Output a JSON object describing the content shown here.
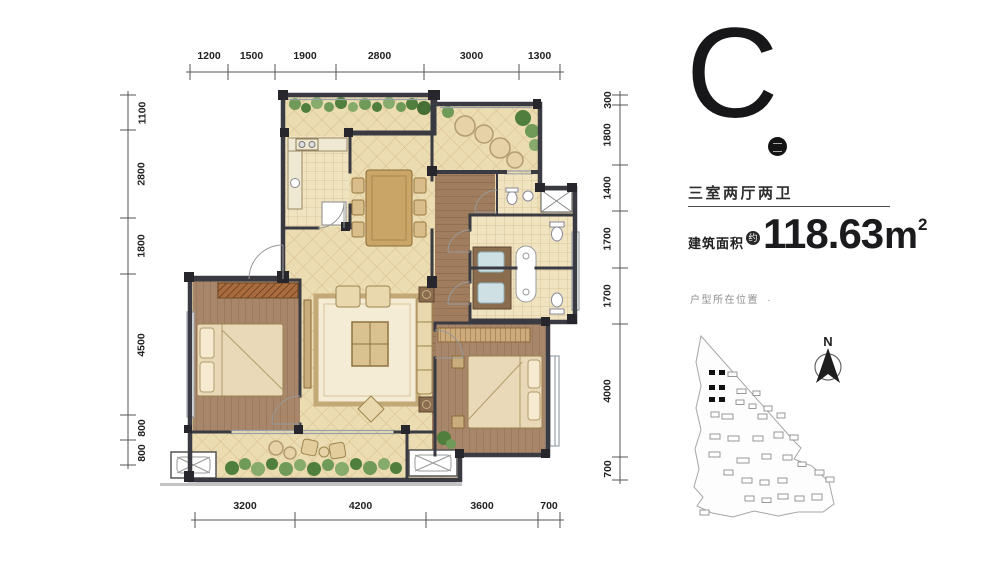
{
  "floor_plan": {
    "dimensions_mm": {
      "top": [
        "1200",
        "1500",
        "1900",
        "2800",
        "3000",
        "1300"
      ],
      "bottom": [
        "3200",
        "4200",
        "3600",
        "700"
      ],
      "left": [
        "1100",
        "2800",
        "1800",
        "4500",
        "800",
        "800"
      ],
      "right": [
        "300",
        "1800",
        "1400",
        "1700",
        "1700",
        "4000",
        "700"
      ]
    },
    "colors": {
      "wall": "#3a3a42",
      "tile_floor": "#ecdcb2",
      "wood_floor": "#a8866a",
      "plants": "#6f9a58",
      "dimension_text": "#222222"
    }
  },
  "info_panel": {
    "unit_label": "C",
    "unit_dot_icon": "filled-circle-badge",
    "unit_type": "三室两厅两卫",
    "area_label": "建筑面积",
    "area_approx_badge": "约",
    "area_value": "118.63",
    "area_unit": "m",
    "area_exponent": "2",
    "location_note": "户型所在位置",
    "location_marker": "·"
  },
  "site_map": {
    "compass_label": "N",
    "highlighted_buildings": 6
  }
}
